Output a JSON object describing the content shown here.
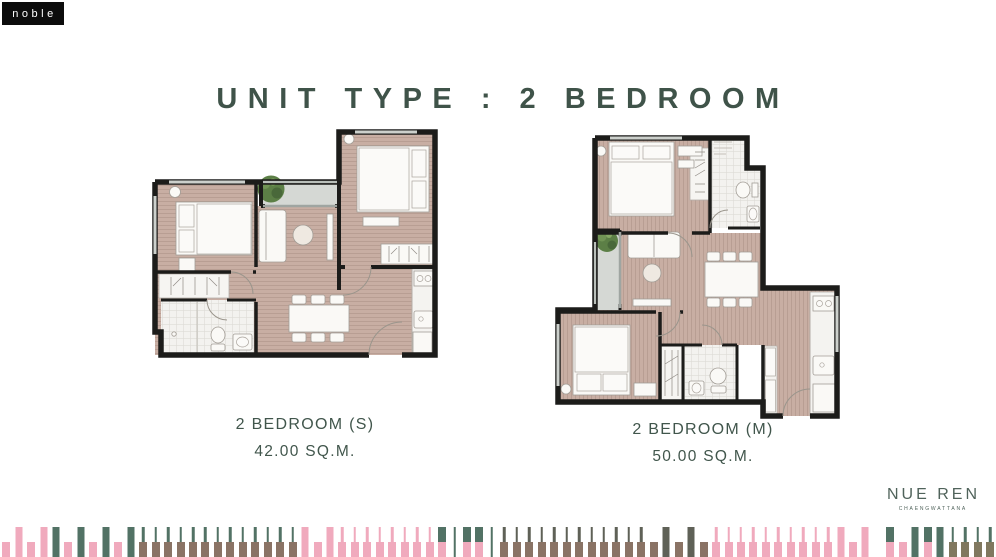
{
  "brand": {
    "logo_text": "noble"
  },
  "title": "UNIT TYPE : 2 BEDROOM",
  "units": [
    {
      "name": "2 BEDROOM (S)",
      "area": "42.00 SQ.M."
    },
    {
      "name": "2 BEDROOM (M)",
      "area": "50.00 SQ.M."
    }
  ],
  "project": {
    "name": "NUE REN",
    "location": "CHAENGWATTANA"
  },
  "colors": {
    "accent_green": "#3f5349",
    "wall_black": "#1c1c1a",
    "floor_rose": "#c8aea3",
    "balcony_gray": "#d5d8d4"
  },
  "footer": {
    "colors": {
      "pink": "#f0aabd",
      "green": "#527265",
      "brown": "#8a7365",
      "dark": "#5f6157",
      "olive": "#80785f"
    },
    "bars": [
      [
        "pink",
        "low"
      ],
      [
        "pink",
        "full"
      ],
      [
        "pink",
        "low"
      ],
      [
        "pink",
        "full"
      ],
      [
        "green",
        "full"
      ],
      [
        "pink",
        "low"
      ],
      [
        "green",
        "full"
      ],
      [
        "pink",
        "low"
      ],
      [
        "green",
        "full"
      ],
      [
        "pink",
        "low"
      ],
      [
        "green",
        "full"
      ],
      [
        "brown",
        "flag",
        "green"
      ],
      [
        "brown",
        "flag",
        "green"
      ],
      [
        "brown",
        "flag",
        "green"
      ],
      [
        "brown",
        "flag",
        "green"
      ],
      [
        "brown",
        "flag",
        "green"
      ],
      [
        "brown",
        "flag",
        "green"
      ],
      [
        "brown",
        "flag",
        "green"
      ],
      [
        "brown",
        "flag",
        "green"
      ],
      [
        "brown",
        "flag",
        "green"
      ],
      [
        "brown",
        "flag",
        "green"
      ],
      [
        "brown",
        "flag",
        "green"
      ],
      [
        "brown",
        "flag",
        "green"
      ],
      [
        "brown",
        "flag",
        "green"
      ],
      [
        "pink",
        "full"
      ],
      [
        "pink",
        "low"
      ],
      [
        "pink",
        "full"
      ],
      [
        "pink",
        "flag",
        "pink"
      ],
      [
        "pink",
        "flag",
        "pink"
      ],
      [
        "pink",
        "flag",
        "pink"
      ],
      [
        "pink",
        "flag",
        "pink"
      ],
      [
        "pink",
        "flag",
        "pink"
      ],
      [
        "pink",
        "flag",
        "pink"
      ],
      [
        "pink",
        "flag",
        "pink"
      ],
      [
        "pink",
        "flag",
        "pink"
      ],
      [
        "green",
        "split",
        "pink"
      ],
      [
        "green",
        "stem"
      ],
      [
        "green",
        "split",
        "pink"
      ],
      [
        "green",
        "split",
        "pink"
      ],
      [
        "green",
        "stem"
      ],
      [
        "brown",
        "flag",
        "dark"
      ],
      [
        "brown",
        "flag",
        "dark"
      ],
      [
        "brown",
        "flag",
        "dark"
      ],
      [
        "brown",
        "flag",
        "dark"
      ],
      [
        "brown",
        "flag",
        "dark"
      ],
      [
        "brown",
        "flag",
        "dark"
      ],
      [
        "brown",
        "flag",
        "dark"
      ],
      [
        "brown",
        "flag",
        "dark"
      ],
      [
        "brown",
        "flag",
        "dark"
      ],
      [
        "brown",
        "flag",
        "dark"
      ],
      [
        "brown",
        "flag",
        "dark"
      ],
      [
        "brown",
        "flag",
        "dark"
      ],
      [
        "brown",
        "low"
      ],
      [
        "dark",
        "full"
      ],
      [
        "brown",
        "low"
      ],
      [
        "dark",
        "full"
      ],
      [
        "brown",
        "low"
      ],
      [
        "pink",
        "flag",
        "pink"
      ],
      [
        "pink",
        "flag",
        "pink"
      ],
      [
        "pink",
        "flag",
        "pink"
      ],
      [
        "pink",
        "flag",
        "pink"
      ],
      [
        "pink",
        "flag",
        "pink"
      ],
      [
        "pink",
        "flag",
        "pink"
      ],
      [
        "pink",
        "flag",
        "pink"
      ],
      [
        "pink",
        "flag",
        "pink"
      ],
      [
        "pink",
        "flag",
        "pink"
      ],
      [
        "pink",
        "flag",
        "pink"
      ],
      [
        "pink",
        "full"
      ],
      [
        "pink",
        "low"
      ],
      [
        "pink",
        "full"
      ],
      [
        "",
        "gap"
      ],
      [
        "green",
        "split",
        "pink"
      ],
      [
        "pink",
        "low"
      ],
      [
        "green",
        "full"
      ],
      [
        "green",
        "split",
        "pink"
      ],
      [
        "green",
        "full"
      ],
      [
        "olive",
        "flag",
        "green"
      ],
      [
        "olive",
        "flag",
        "green"
      ],
      [
        "olive",
        "flag",
        "green"
      ],
      [
        "olive",
        "flag",
        "green"
      ]
    ]
  }
}
